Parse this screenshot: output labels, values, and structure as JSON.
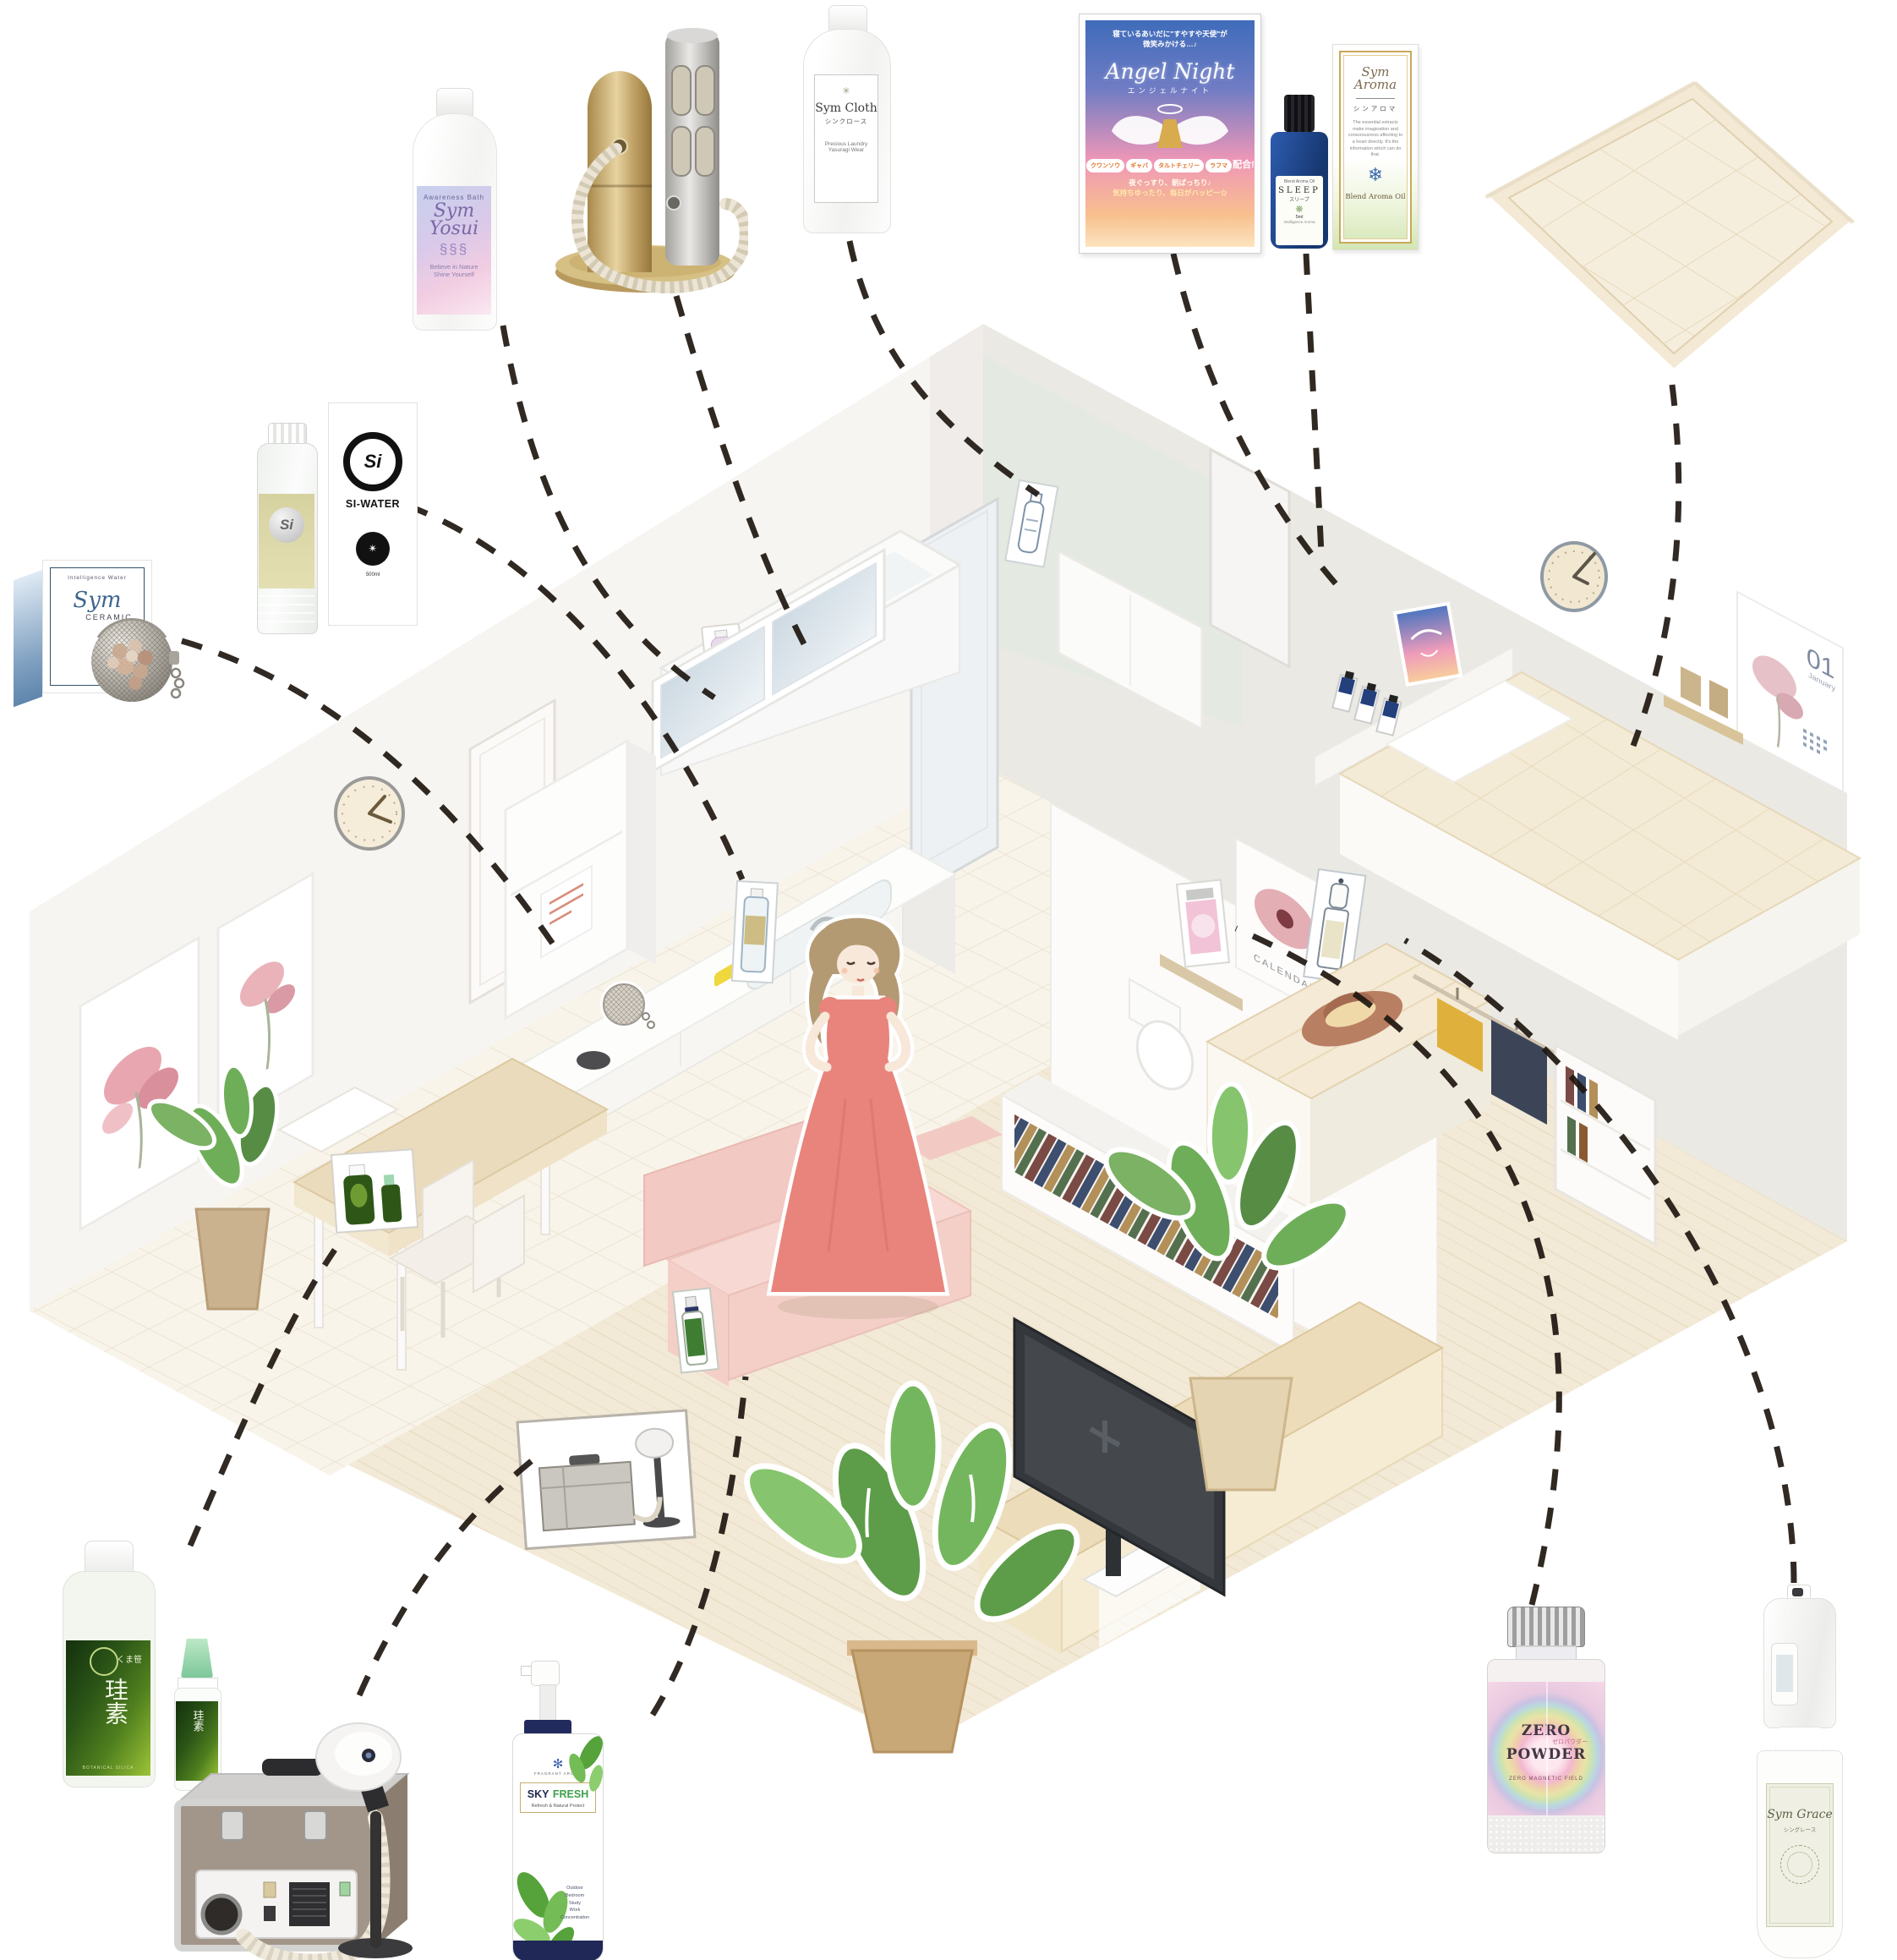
{
  "palette": {
    "connector": "#1f1710",
    "floor_wood": "#f2e9d6",
    "wall_left": "#f7f5f2",
    "wall_right": "#ebe9e4",
    "accent_gold": "#c9a957"
  },
  "room": {
    "bedroom_calendar_number": "01",
    "bedroom_calendar_month": "January",
    "closet_poster_title": "CALENDAR"
  },
  "products": {
    "sym_yosui": {
      "tagline": "Awareness Bath",
      "title": "Sym Yosui",
      "dna_icon": "§§§",
      "footer1": "Believe in Nature",
      "footer2": "Shine Yourself"
    },
    "sym_cloth": {
      "sun_icon": "✳",
      "title": "Sym Cloth",
      "kana": "シンクロース",
      "sub1": "Precious Laundry",
      "sub2": "Yasuragi Wear"
    },
    "angel_night": {
      "header1": "寝ているあいだに\"すやすや天使\"が",
      "header2": "微笑みかける…♪",
      "title": "Angel Night",
      "kana": "エンジェルナイト",
      "badges": [
        "クワンソウ",
        "ギャバ",
        "タルトチェリー",
        "ラフマ"
      ],
      "badge_suffix": "配合!",
      "footer1": "夜ぐっすり、朝ぱっちり♪",
      "footer2": "気持ちゆったり、毎日がハッピー☆"
    },
    "sleep_oil": {
      "brand": "Blend Aroma Oil",
      "title": "SLEEP",
      "kana": "スリープ",
      "mandala_icon": "❋",
      "size": "5ml",
      "series": "Intelligence Aroma"
    },
    "sym_aroma": {
      "title": "Sym Aroma",
      "kana": "シンアロマ",
      "desc": "The essential extracts make imagination and consciousness affecting to a heart directly. It's the information which can do that.",
      "snowflake_icon": "❄",
      "footer": "Blend Aroma Oil"
    },
    "si_water": {
      "logo": "Si",
      "title": "SI-WATER",
      "emblem_icon": "✴",
      "size": "500ml"
    },
    "sym_ceramic": {
      "header": "Intelligence Water",
      "title": "Sym",
      "subtitle": "CERAMIC",
      "sun_icon": "✺"
    },
    "keiso": {
      "brand": "くま笹",
      "title": "珪素",
      "note": "BOTANICAL SILICA"
    },
    "sky_fresh": {
      "mandala_icon": "✻",
      "brand": "FRAGRANT AROMA",
      "title1": "SKY",
      "title2": "FRESH",
      "sub": "Refresh & Natural Protect",
      "uses": [
        "Outdoor",
        "Bedroom",
        "Study",
        "Work",
        "Concentration"
      ]
    },
    "zero_powder": {
      "title1": "ZERO",
      "title2": "POWDER",
      "kana": "ゼロパウダー",
      "footer": "ZERO MAGNETIC FIELD"
    },
    "sym_grace": {
      "title": "Sym Grace",
      "kana": "シングレース"
    }
  }
}
